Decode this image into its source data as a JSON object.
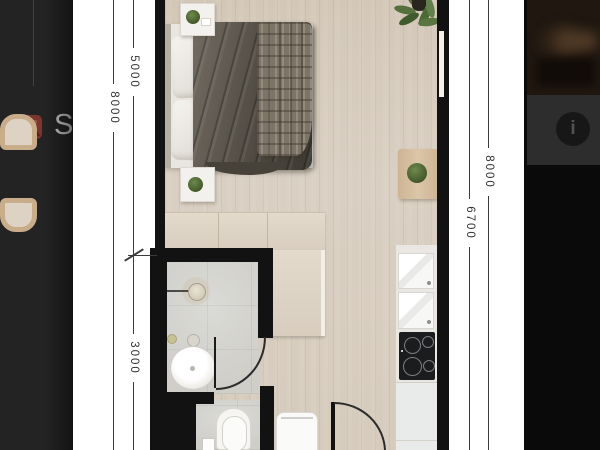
{
  "app": {
    "type": "photo-lightbox-over-listing-page",
    "colors": {
      "lightbox_background": "#0b0b0b",
      "photo_panel": "#ffffff",
      "dimmed_page": "#232323",
      "listing_icon_accent": "#7c362c",
      "dimension_line": "#3b3b3b",
      "plan_walls": "#121212",
      "wood_floor": "#d7ccbe",
      "tile_floor": "#d5d4d0"
    }
  },
  "background_page": {
    "listing": {
      "icon": "image-icon",
      "title_visible": "St"
    }
  },
  "right_rail": {
    "thumbnail": "photo-thumbnail",
    "info_button": {
      "icon": "info-icon",
      "glyph": "i"
    }
  },
  "floor_plan": {
    "image_type": "photorealistic-top-down-studio-apartment-render",
    "dimension_labels": {
      "left_outer": "8000",
      "left_inner_top": "5000",
      "left_inner_bottom": "3000",
      "right_inner": "6700",
      "right_outer": "8000"
    },
    "rooms": [
      "bedroom-living-area",
      "bathroom",
      "wc-nook",
      "kitchen-strip",
      "entry"
    ],
    "features": [
      "double-bed",
      "pillows",
      "plaid-throw",
      "duvet",
      "nightstands",
      "potted-plants",
      "corner-plant",
      "wardrobe",
      "shower-head",
      "washbasin",
      "toilet",
      "washing-machine",
      "two-lounge-chairs",
      "side-table",
      "kitchen-counter",
      "sink-units",
      "induction-hob",
      "window",
      "door-swing-arcs"
    ]
  }
}
